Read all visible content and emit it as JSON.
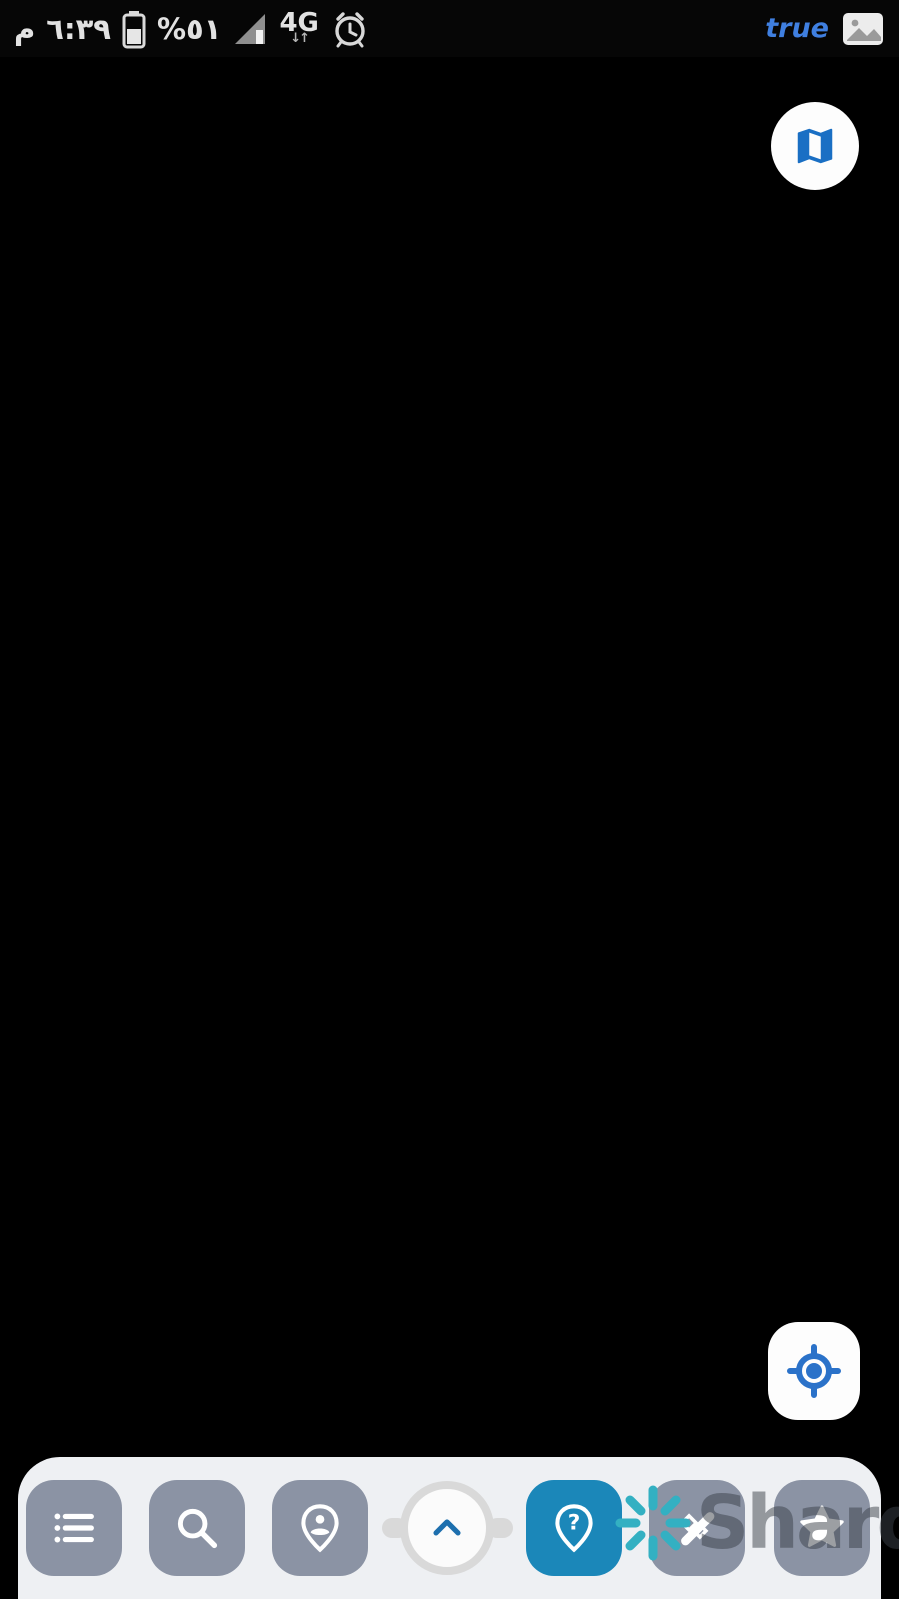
{
  "status_bar": {
    "meridiem": "م",
    "time": "٦:٣٩",
    "battery_percent": "%٥١",
    "network": "4G",
    "network_arrows": "↓↑",
    "carrier_notification": "true",
    "icons": [
      "battery-icon",
      "signal-icon",
      "alarm-clock-icon",
      "gallery-icon"
    ]
  },
  "colors": {
    "parcel_line": "#ee1111",
    "selection_blue": "#1717d6",
    "badge_bg": "#aed3ec",
    "badge_text": "#2a66d8",
    "accent_blue": "#2b72c9",
    "toolbar_active": "#1b87b9",
    "toolbar_button": "#8b93a4",
    "watermark_teal": "#33b0c2"
  },
  "watermark": {
    "text": "Sharq",
    "icon": "spark-icon"
  },
  "floating_buttons": {
    "map_type": {
      "icon": "map-icon"
    },
    "gps": {
      "icon": "gps-target-icon"
    }
  },
  "toolbar": {
    "buttons": [
      {
        "id": "layers-list",
        "icon": "list-icon",
        "active": false
      },
      {
        "id": "search",
        "icon": "search-icon",
        "active": false
      },
      {
        "id": "person-location",
        "icon": "person-pin-icon",
        "active": false
      },
      {
        "id": "expand-panel",
        "icon": "chevron-up-icon",
        "active": false
      },
      {
        "id": "parcel-query",
        "icon": "help-pin-icon",
        "active": true
      },
      {
        "id": "measure",
        "icon": "measure-icon",
        "active": false
      },
      {
        "id": "favorites",
        "icon": "star-icon",
        "active": false
      }
    ]
  },
  "map": {
    "town_label": {
      "t": "الرمثا",
      "x": 445,
      "y": 786,
      "s": 52
    },
    "selected_parcel": {
      "number": "222",
      "rect": {
        "x": 707,
        "y": 596,
        "w": 74,
        "h": 145
      },
      "corners": [
        {
          "t": "5",
          "x": 687,
          "y": 600
        },
        {
          "t": "1",
          "x": 755,
          "y": 604
        },
        {
          "t": "3",
          "x": 687,
          "y": 729
        },
        {
          "t": "2",
          "x": 753,
          "y": 736
        }
      ]
    },
    "labels": [
      {
        "t": "200",
        "x": 36,
        "y": 100,
        "s": 42
      },
      {
        "t": "112",
        "x": 295,
        "y": 85,
        "s": 42
      },
      {
        "t": "114",
        "x": 420,
        "y": 126,
        "s": 42
      },
      {
        "t": "115",
        "x": 102,
        "y": 172,
        "s": 42
      },
      {
        "t": "116",
        "x": 382,
        "y": 222,
        "s": 42
      },
      {
        "t": "117",
        "x": 265,
        "y": 280,
        "s": 42
      },
      {
        "t": "118",
        "x": 438,
        "y": 302,
        "s": 42
      },
      {
        "t": "165",
        "x": 660,
        "y": 84,
        "s": 42
      },
      {
        "t": "49",
        "x": 800,
        "y": 95,
        "s": 42
      },
      {
        "t": "50",
        "x": 685,
        "y": 193,
        "s": 42
      },
      {
        "t": "50",
        "x": 830,
        "y": 186,
        "s": 42
      },
      {
        "t": "83",
        "x": 692,
        "y": 257,
        "s": 42
      },
      {
        "t": "83",
        "x": 855,
        "y": 250,
        "s": 42
      },
      {
        "t": "84",
        "x": 730,
        "y": 335,
        "s": 42
      },
      {
        "t": "119",
        "x": 218,
        "y": 458,
        "s": 42
      },
      {
        "t": "26",
        "x": 500,
        "y": 540,
        "s": 40
      },
      {
        "t": "218",
        "x": 715,
        "y": 485,
        "s": 40
      },
      {
        "t": "217",
        "x": 856,
        "y": 485,
        "s": 40
      },
      {
        "t": "120",
        "x": 160,
        "y": 660,
        "s": 42
      },
      {
        "t": "195",
        "x": 40,
        "y": 714,
        "s": 42
      },
      {
        "t": "196",
        "x": 138,
        "y": 780,
        "s": 42
      },
      {
        "t": "219",
        "x": 535,
        "y": 672,
        "s": 40
      },
      {
        "t": "220",
        "x": 612,
        "y": 652,
        "s": 40
      },
      {
        "t": "221",
        "x": 697,
        "y": 620,
        "s": 40
      },
      {
        "t": "222",
        "x": 730,
        "y": 664,
        "s": 40
      },
      {
        "t": "223",
        "x": 820,
        "y": 666,
        "s": 40
      },
      {
        "t": "197",
        "x": 42,
        "y": 876,
        "s": 42
      },
      {
        "t": "58",
        "x": 128,
        "y": 900,
        "s": 40
      },
      {
        "t": "811",
        "x": 718,
        "y": 760,
        "s": 40
      },
      {
        "t": "812",
        "x": 683,
        "y": 805,
        "s": 40
      },
      {
        "t": "448",
        "x": 650,
        "y": 866,
        "s": 40
      },
      {
        "t": "786",
        "x": 360,
        "y": 773,
        "s": 44
      },
      {
        "t": "1",
        "x": 340,
        "y": 815,
        "s": 42
      },
      {
        "t": "59",
        "x": 98,
        "y": 1005,
        "s": 42
      },
      {
        "t": "81",
        "x": 83,
        "y": 1115,
        "s": 42
      },
      {
        "t": "82",
        "x": 72,
        "y": 1218,
        "s": 42
      },
      {
        "t": "369",
        "x": 470,
        "y": 1116,
        "s": 42
      },
      {
        "t": "685",
        "x": 810,
        "y": 1062,
        "s": 42
      },
      {
        "t": "684",
        "x": 855,
        "y": 1220,
        "s": 42
      },
      {
        "t": "32",
        "x": 483,
        "y": 1268,
        "s": 40
      },
      {
        "t": "149",
        "x": 40,
        "y": 1306,
        "s": 40
      },
      {
        "t": "148",
        "x": 73,
        "y": 1360,
        "s": 42
      },
      {
        "t": "820",
        "x": 405,
        "y": 1355,
        "s": 42
      },
      {
        "t": "819",
        "x": 432,
        "y": 1420,
        "s": 42
      },
      {
        "t": "96",
        "x": 872,
        "y": 1322,
        "s": 42
      },
      {
        "t": "73",
        "x": 758,
        "y": 1402,
        "s": 42
      },
      {
        "t": "15",
        "x": 20,
        "y": 1462,
        "s": 42
      }
    ],
    "fractions": [
      {
        "t": "787",
        "sup": "2",
        "bx1": 330,
        "bx2": 410,
        "by": 885,
        "tx": 368,
        "ty": 912,
        "sx": 437,
        "sy": 873
      },
      {
        "t": "787",
        "sup": "3",
        "bx1": 422,
        "bx2": 505,
        "by": 935,
        "tx": 460,
        "ty": 962,
        "sx": 520,
        "sy": 940
      },
      {
        "t": "787",
        "sup": "",
        "bx1": 505,
        "bx2": 592,
        "by": 1003,
        "tx": 547,
        "ty": 1030,
        "sx": 0,
        "sy": 0
      }
    ],
    "patches": [
      {
        "p": "0,57 899,57 899,1599 0,1599",
        "f": "#8b7a58"
      },
      {
        "p": "575,57 899,57 899,235 660,127",
        "f": "#a29272"
      },
      {
        "p": "95,57 575,57 522,235 432,470 62,342",
        "f": "#606448",
        "o": "dots"
      },
      {
        "p": "0,57 95,57 62,342 0,385",
        "f": "#90815f"
      },
      {
        "p": "62,342 432,470 332,690 0,700 0,385",
        "f": "#7d6b4b",
        "o": "dots"
      },
      {
        "p": "660,127 899,235 899,362 560,390 522,235",
        "f": "#8b7550"
      },
      {
        "p": "560,390 899,362 899,558 522,577 432,470",
        "f": "#6f684a",
        "o": "dots"
      },
      {
        "p": "522,577 899,558 899,714 302,708 332,690",
        "f": "#93835f"
      },
      {
        "p": "302,708 622,713 602,1006 232,1009 252,906",
        "f": "#64734a",
        "o": "rows"
      },
      {
        "p": "622,713 899,714 899,1311 560,1313 602,1006",
        "f": "#8d7150"
      },
      {
        "p": "0,700 302,708 252,906 207,1121 160,1281 0,1281",
        "f": "#6a6245",
        "o": "dots"
      },
      {
        "p": "0,1281 899,1313 899,1599 0,1599",
        "f": "#8a7151"
      },
      {
        "p": "228,1213 899,1171 899,1311 560,1313 154,1288",
        "f": "#6c6445",
        "o": "dots"
      },
      {
        "p": "0,560 132,573 136,700 0,700",
        "f": "#b3ab94"
      },
      {
        "p": "480,178 575,170 580,235 488,242",
        "f": "#5d5b45"
      },
      {
        "p": "497,186 543,182 546,212 500,216",
        "f": "#cfc6ab"
      },
      {
        "p": "20,600 55,596 57,622 22,626",
        "f": "#d8d2c0"
      },
      {
        "p": "70,640 100,637 102,660 72,663",
        "f": "#c9c2ae"
      },
      {
        "p": "262,925 292,921 295,946 265,950",
        "f": "#d5cdb9"
      },
      {
        "p": "705,915 742,912 745,955 708,958",
        "f": "#3f4a33"
      }
    ],
    "lines": [
      {
        "k": "road",
        "p": "575,57 520,235 430,470 330,690 250,905 205,1120 158,1281"
      },
      {
        "k": "road",
        "p": "158,1281 212,1398 265,1495"
      },
      {
        "k": "band",
        "p": "152,1288 899,1315"
      },
      {
        "k": "d",
        "p": "520,233 660,126"
      },
      {
        "k": "d",
        "p": "660,126 899,46"
      },
      {
        "k": "d",
        "p": "660,126 899,152"
      },
      {
        "k": "d",
        "p": "612,258 899,227"
      },
      {
        "k": "d",
        "p": "540,333 899,301"
      },
      {
        "k": "d",
        "p": "520,577 899,557"
      },
      {
        "k": "d",
        "p": "302,708 899,715"
      },
      {
        "k": "d",
        "p": "0,691 136,699"
      },
      {
        "k": "d",
        "p": "0,853 262,875"
      },
      {
        "k": "d",
        "p": "228,1213 899,1171"
      },
      {
        "k": "d",
        "p": "162,1432 899,1374"
      },
      {
        "k": "d",
        "p": "0,1244 154,1266"
      },
      {
        "k": "s",
        "p": "75,59 470,58"
      },
      {
        "k": "s",
        "p": "95,57 52,345"
      },
      {
        "k": "s",
        "p": "0,132 225,100"
      },
      {
        "k": "s",
        "p": "237,57 221,133"
      },
      {
        "k": "s",
        "p": "0,282 221,252 540,187"
      },
      {
        "k": "s",
        "p": "221,133 205,256 181,341"
      },
      {
        "k": "s",
        "p": "205,256 601,209"
      },
      {
        "k": "s",
        "p": "181,341 638,264"
      },
      {
        "k": "s",
        "p": "505,380 899,353"
      },
      {
        "k": "s",
        "p": "648,366 634,578"
      },
      {
        "k": "s",
        "p": "790,369 782,559"
      },
      {
        "k": "s",
        "p": "634,578 646,708"
      },
      {
        "k": "s",
        "p": "800,591 806,713"
      },
      {
        "k": "s",
        "p": "622,714 617,813"
      },
      {
        "k": "s",
        "p": "300,830 620,813 899,803"
      },
      {
        "k": "s",
        "p": "322,695 316,792 300,830"
      },
      {
        "k": "s",
        "p": "136,699 332,690"
      },
      {
        "k": "s",
        "p": "285,872 660,846"
      },
      {
        "k": "s",
        "p": "252,952 662,914"
      },
      {
        "k": "s",
        "p": "232,1009 700,963 899,952"
      },
      {
        "k": "s",
        "p": "742,966 760,815"
      },
      {
        "k": "s",
        "p": "0,947 232,977"
      },
      {
        "k": "s",
        "p": "0,1054 216,1084"
      },
      {
        "k": "s",
        "p": "0,1160 216,1190"
      },
      {
        "k": "s",
        "p": "736,1033 706,1291"
      },
      {
        "k": "s",
        "p": "756,1213 899,1186"
      },
      {
        "k": "s",
        "p": "838,1316 796,1520"
      },
      {
        "k": "s",
        "p": "560,1314 540,1455"
      },
      {
        "k": "s",
        "p": "680,1316 663,1462"
      }
    ],
    "vertices": [
      {
        "x": 95,
        "y": 58,
        "t": "c"
      },
      {
        "x": 52,
        "y": 345,
        "t": "c"
      },
      {
        "x": 221,
        "y": 133,
        "t": "c"
      },
      {
        "x": 205,
        "y": 256,
        "t": "c"
      },
      {
        "x": 181,
        "y": 341,
        "t": "c"
      },
      {
        "x": 520,
        "y": 233,
        "t": "c"
      },
      {
        "x": 612,
        "y": 258,
        "t": "c"
      },
      {
        "x": 540,
        "y": 333,
        "t": "c"
      },
      {
        "x": 505,
        "y": 380,
        "t": "c"
      },
      {
        "x": 648,
        "y": 366,
        "t": "c"
      },
      {
        "x": 790,
        "y": 369,
        "t": "c"
      },
      {
        "x": 800,
        "y": 591,
        "t": "c"
      },
      {
        "x": 806,
        "y": 713,
        "t": "c"
      },
      {
        "x": 622,
        "y": 714,
        "t": "c"
      },
      {
        "x": 742,
        "y": 966,
        "t": "c"
      },
      {
        "x": 232,
        "y": 1009,
        "t": "c"
      },
      {
        "x": 136,
        "y": 699,
        "t": "c"
      },
      {
        "x": 322,
        "y": 695,
        "t": "c"
      },
      {
        "x": 560,
        "y": 1314,
        "t": "c"
      },
      {
        "x": 680,
        "y": 1316,
        "t": "c"
      },
      {
        "x": 162,
        "y": 1432,
        "t": "c"
      },
      {
        "x": 285,
        "y": 872,
        "t": "c"
      },
      {
        "x": 252,
        "y": 952,
        "t": "c"
      },
      {
        "x": 330,
        "y": 690,
        "t": "r"
      },
      {
        "x": 633,
        "y": 578,
        "t": "r"
      },
      {
        "x": 646,
        "y": 708,
        "t": "r"
      },
      {
        "x": 158,
        "y": 1281,
        "t": "r"
      },
      {
        "x": 705,
        "y": 1291,
        "t": "r"
      },
      {
        "x": 756,
        "y": 1213,
        "t": "r"
      },
      {
        "x": 838,
        "y": 1316,
        "t": "r"
      },
      {
        "x": 228,
        "y": 1213,
        "t": "r"
      },
      {
        "x": 262,
        "y": 875,
        "t": "r"
      },
      {
        "x": 700,
        "y": 963,
        "t": "r"
      },
      {
        "x": 660,
        "y": 126,
        "t": "d"
      },
      {
        "x": 458,
        "y": 700,
        "t": "d"
      },
      {
        "x": 580,
        "y": 1320,
        "t": "d"
      },
      {
        "x": 246,
        "y": 890,
        "t": "d"
      },
      {
        "x": 821,
        "y": 738,
        "t": "d"
      },
      {
        "x": 345,
        "y": 1259,
        "t": "d"
      }
    ]
  }
}
